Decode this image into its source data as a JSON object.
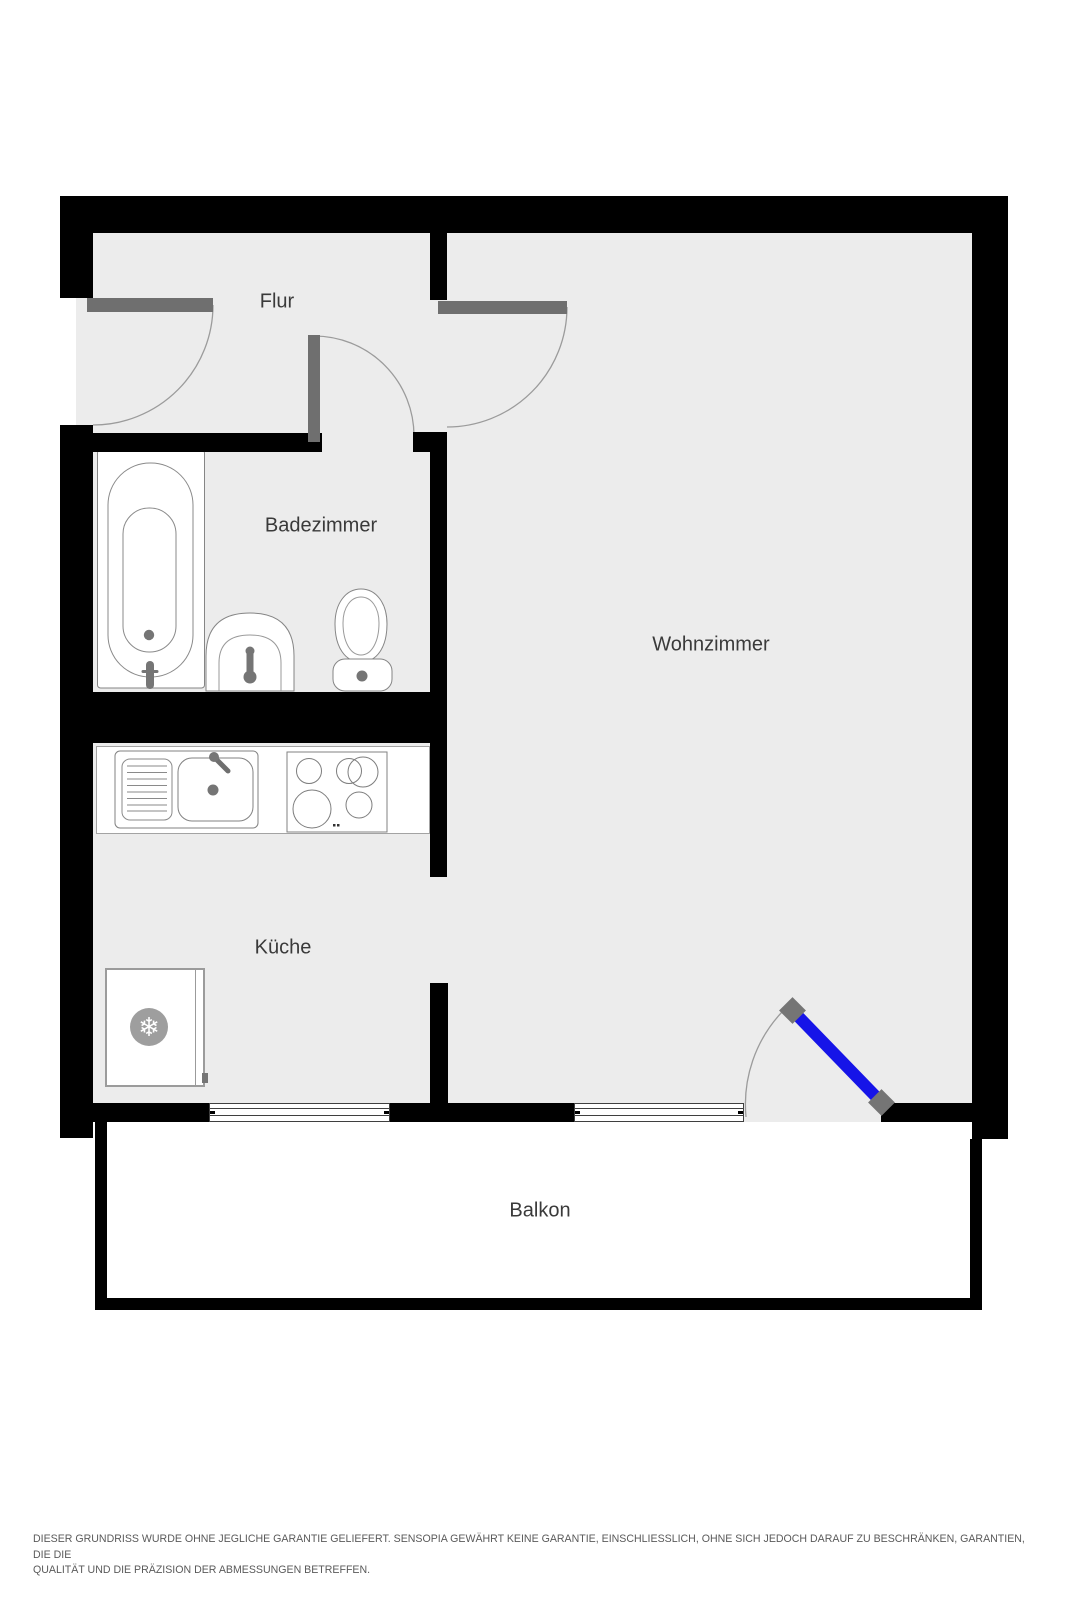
{
  "floorplan": {
    "rooms": [
      {
        "key": "flur",
        "label": "Flur"
      },
      {
        "key": "badezimmer",
        "label": "Badezimmer"
      },
      {
        "key": "wohnzimmer",
        "label": "Wohnzimmer"
      },
      {
        "key": "kueche",
        "label": "Küche"
      },
      {
        "key": "balkon",
        "label": "Balkon"
      }
    ],
    "icons": {
      "fridge_snowflake": "❄"
    },
    "colors": {
      "wall": "#000000",
      "floor": "#ececec",
      "door_leaf_gray": "#6f6f6f",
      "balcony_door_blue": "#1614e8",
      "hinge_gray": "#757575",
      "fixture_outline": "#858585",
      "label_text": "#3a3a3a"
    }
  },
  "footer": {
    "line1": "DIESER GRUNDRISS WURDE OHNE JEGLICHE GARANTIE GELIEFERT. SENSOPIA GEWÄHRT KEINE GARANTIE, EINSCHLIESSLICH, OHNE SICH JEDOCH DARAUF ZU BESCHRÄNKEN, GARANTIEN, DIE DIE",
    "line2": "QUALITÄT UND DIE PRÄZISION DER ABMESSUNGEN BETREFFEN."
  }
}
